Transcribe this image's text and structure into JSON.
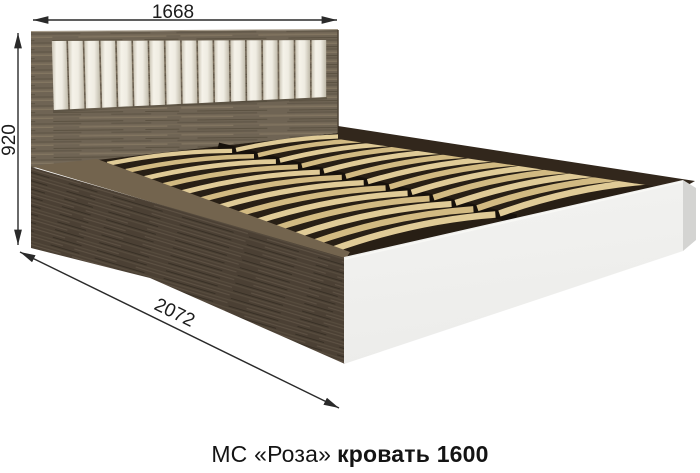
{
  "product": {
    "caption_regular": "МС «Роза»",
    "caption_bold": "кровать 1600"
  },
  "dimensions": {
    "width": "1668",
    "height": "920",
    "length": "2072"
  },
  "illustration": {
    "cushion_count": 17,
    "slats_per_column": 13,
    "colors": {
      "headboard_wood": "#6f6454",
      "headboard_grain_light": "#857863",
      "headboard_grain_dark": "#584f3f",
      "rail_wood": "#4b4034",
      "rail_grain_light": "#5f5345",
      "rail_grain_dark": "#362e24",
      "rail_top": "#73644e",
      "rim_dark": "#32271c",
      "platform_shadow": "#281f15",
      "slat_light": "#e0cb97",
      "slat_dark": "#d2ba82",
      "cushion_light": "#f5f2e9",
      "cushion_shadow": "#c9c3b3",
      "panel_front": "#ececea",
      "panel_side": "#d4d4d2",
      "dimension_line": "#2a2a2a",
      "caption_text": "#141414"
    }
  }
}
